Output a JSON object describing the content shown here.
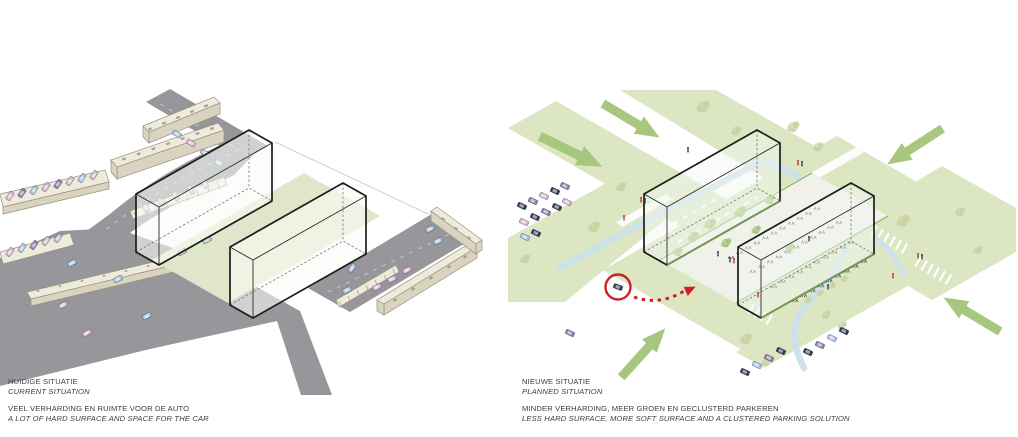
{
  "page": {
    "width": 1018,
    "height": 437,
    "background": "#ffffff"
  },
  "panels": {
    "left": {
      "id": "current-situation",
      "title": "HUIDIGE SITUATIE",
      "subtitle": "CURRENT SITUATION",
      "caption": "VEEL VERHARDING EN RUIMTE VOOR DE AUTO",
      "caption_en": "A LOT OF  HARD SURFACE AND SPACE FOR THE CAR"
    },
    "right": {
      "id": "planned-situation",
      "title": "NIEUWE SITUATIE",
      "subtitle": "PLANNED SITUATION",
      "caption": "MINDER VERHARDING, MEER GROEN EN GECLUSTERD PARKEREN",
      "caption_en": "LESS HARD SURFACE, MORE SOFT SURFACE AND A CLUSTERED PARKING SOLUTION"
    }
  },
  "icons": {
    "green_arrow": "thick-green-directional-arrow",
    "red_circle": "red-highlight-circle-around-car",
    "red_dashed_arrow": "red-dashed-relocation-arrow",
    "car": "small-isometric-car",
    "tree": "sketchy-tree-clump",
    "person": "tiny-person-figure",
    "bike_rack": "bicycle-rack-mark"
  },
  "colors": {
    "road": "#96969b",
    "building": "#e9e5d3",
    "building_top": "#efebdb",
    "building_side": "#d9d3bf",
    "building_outline": "#97927f",
    "courtyard_green": "#dfe6c9",
    "field_green": "#dce6c3",
    "arrow_green": "#a6c77d",
    "stream_blue": "#c9e1ec",
    "box_outline": "#1c1c1c",
    "red_accent": "#cf2028",
    "car_pink": "#d8b6d0",
    "car_blue": "#a9c3dc",
    "car_navy": "#323a56",
    "car_purple": "#8d7fae",
    "tree_olive": "#c9cfa0",
    "tree_green": "#9dc271",
    "text": "#3d3d3f"
  }
}
